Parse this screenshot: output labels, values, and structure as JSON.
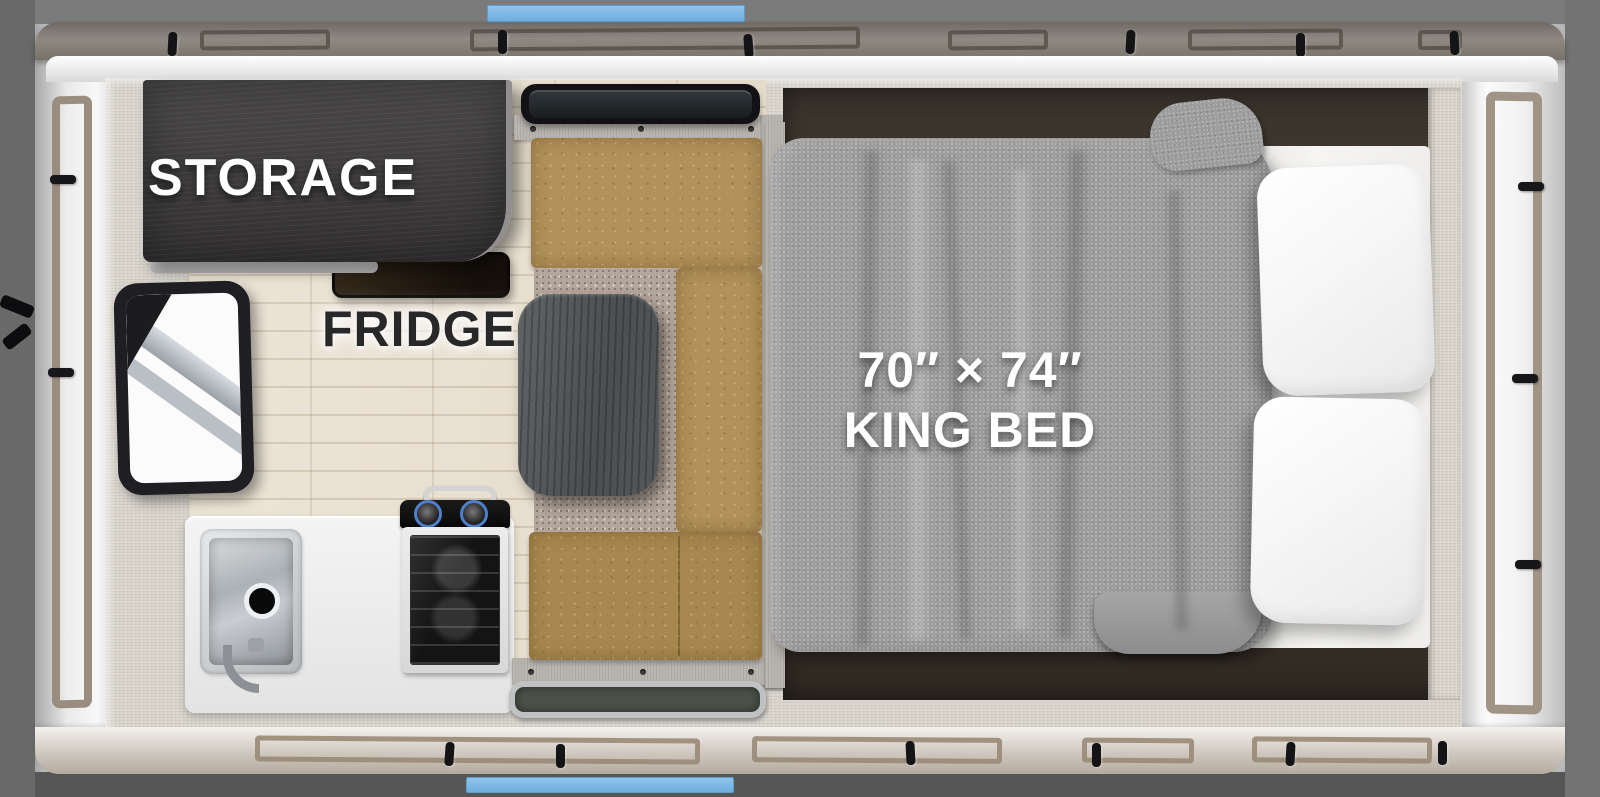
{
  "floorplan": {
    "labels": {
      "storage": "STORAGE",
      "fridge": "FRIDGE",
      "bed_size": "70″ × 74″",
      "bed_type": "KING BED"
    },
    "fixtures": [
      "storage-cabinet",
      "fridge-location",
      "window",
      "kitchen-counter",
      "sink",
      "faucet",
      "stove-cooktop",
      "oven",
      "dinette-table",
      "dinette-bench-seating",
      "overhead-tray",
      "area-carpet",
      "entry-mat",
      "king-bed",
      "bed-pillows",
      "bed-blanket",
      "awning-rails",
      "roof-accent-bars"
    ],
    "colors": {
      "background_gray": "#757575",
      "accent_blue": "#7fbae7",
      "exterior_band_top": "#8a857e",
      "exterior_band_bottom": "#c9c2b9",
      "interior_wall": "#d8d4cc",
      "floor_wood": "#e9e1d2",
      "cabinet_dark": "#3d3b3c",
      "bench_leather_tan": "#b29259",
      "table_gray": "#54575a",
      "counter_white": "#efefef",
      "bed_platform_brown": "#3a332b",
      "blanket_gray": "#9d9d9d",
      "pillow_white": "#fbfbfb",
      "label_white": "#ffffff",
      "label_dark": "#282828"
    }
  }
}
